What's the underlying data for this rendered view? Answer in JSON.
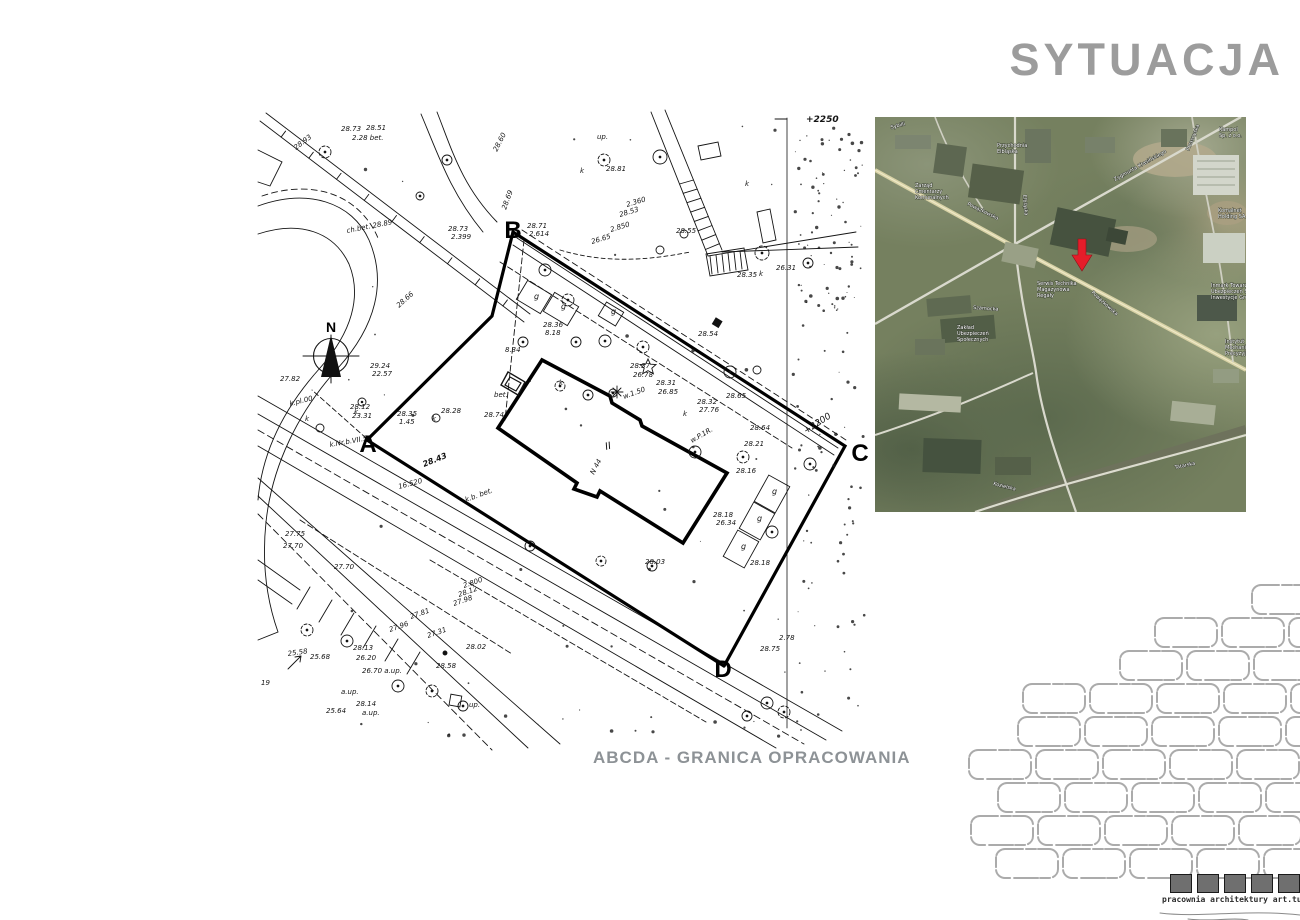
{
  "page": {
    "title": "SYTUACJA",
    "caption": "ABCDA - GRANICA OPRACOWANIA"
  },
  "colors": {
    "title_gray": "#9c9c9c",
    "caption_gray": "#8d9296",
    "map_ink": "#141414",
    "marker_red": "#e51d2a",
    "brick_gray": "#ababab",
    "logo_square_gray": "#6f6f6f"
  },
  "footer": {
    "studio": "pracownia architektury art.tu",
    "square_count": 5
  },
  "site_plan": {
    "north_label": "N",
    "building_label": "II",
    "boundary_points": [
      {
        "label": "A",
        "x": 368,
        "y": 452
      },
      {
        "label": "B",
        "x": 513,
        "y": 238
      },
      {
        "label": "C",
        "x": 860,
        "y": 461
      },
      {
        "label": "D",
        "x": 723,
        "y": 677
      }
    ],
    "annotations": [
      [
        "28.73",
        341,
        131,
        0
      ],
      [
        "28.51",
        366,
        130,
        0
      ],
      [
        "2.28 bet.",
        352,
        140,
        0
      ],
      [
        "28.93",
        296,
        150,
        -37
      ],
      [
        "28.60",
        497,
        152,
        -63
      ],
      [
        "28.69",
        506,
        210,
        -70
      ],
      [
        "28.73",
        448,
        231,
        0
      ],
      [
        "2.399",
        451,
        239,
        0
      ],
      [
        "28.71",
        527,
        228,
        0
      ],
      [
        "2.614",
        529,
        236,
        0
      ],
      [
        "up.",
        597,
        139,
        0
      ],
      [
        "28.81",
        606,
        171,
        0
      ],
      [
        "2.360",
        627,
        207,
        -17
      ],
      [
        "28.53",
        620,
        217,
        -17
      ],
      [
        "2.850",
        611,
        232,
        -17
      ],
      [
        "26.65",
        592,
        244,
        -17
      ],
      [
        "28.55",
        676,
        233,
        0
      ],
      [
        "28.35",
        737,
        277,
        0
      ],
      [
        "26.31",
        776,
        270,
        0
      ],
      [
        "28.54",
        698,
        336,
        0
      ],
      [
        "28.36",
        543,
        327,
        0
      ],
      [
        "8.18",
        545,
        335,
        0
      ],
      [
        "8.34",
        505,
        352,
        0
      ],
      [
        "bet.",
        494,
        397,
        0
      ],
      [
        "28.74",
        484,
        417,
        0
      ],
      [
        "28.37",
        630,
        368,
        0
      ],
      [
        "26.78",
        633,
        377,
        0
      ],
      [
        "28.31",
        656,
        385,
        0
      ],
      [
        "26.85",
        658,
        394,
        0
      ],
      [
        "w.1.50",
        624,
        399,
        -20
      ],
      [
        "28.32",
        697,
        404,
        0
      ],
      [
        "27.76",
        699,
        412,
        0
      ],
      [
        "28.65",
        726,
        398,
        0
      ],
      [
        "28.64",
        750,
        430,
        0
      ],
      [
        "28.21",
        744,
        446,
        0
      ],
      [
        "28.16",
        736,
        473,
        0
      ],
      [
        "w.P.1R.",
        692,
        443,
        -30
      ],
      [
        "N 44",
        594,
        475,
        -62
      ],
      [
        "28.18",
        713,
        517,
        0
      ],
      [
        "26.34",
        716,
        525,
        0
      ],
      [
        "28.18",
        750,
        565,
        0
      ],
      [
        "28.03",
        645,
        564,
        0
      ],
      [
        "28.12",
        350,
        409,
        0
      ],
      [
        "23.31",
        352,
        418,
        0
      ],
      [
        "28.35",
        397,
        416,
        0
      ],
      [
        "1.45",
        399,
        424,
        0
      ],
      [
        "28.28",
        441,
        413,
        0
      ],
      [
        "28.43",
        424,
        467,
        -22,
        8,
        1
      ],
      [
        "16.520",
        399,
        489,
        -15
      ],
      [
        "k.Nr.b.VII.5",
        330,
        447,
        -10
      ],
      [
        "29.24",
        370,
        368,
        0
      ],
      [
        "22.57",
        372,
        376,
        0
      ],
      [
        "ch.bet. 28.89",
        347,
        233,
        -11
      ],
      [
        "28.66",
        399,
        308,
        -42
      ],
      [
        "27.82",
        280,
        381,
        0
      ],
      [
        "k.pl.00",
        290,
        406,
        -14
      ],
      [
        "27.75",
        285,
        536,
        0
      ],
      [
        "27.70",
        283,
        548,
        0
      ],
      [
        "27.70",
        334,
        569,
        0
      ],
      [
        "2.800",
        464,
        588,
        -19
      ],
      [
        "28.12",
        459,
        597,
        -19
      ],
      [
        "27.98",
        454,
        606,
        -19
      ],
      [
        "27.81",
        411,
        619,
        -19
      ],
      [
        "27.96",
        390,
        632,
        -19
      ],
      [
        "27.31",
        428,
        638,
        -19
      ],
      [
        "28.02",
        466,
        649,
        0
      ],
      [
        "28.58",
        436,
        668,
        0
      ],
      [
        "28.13",
        353,
        650,
        0
      ],
      [
        "26.20",
        356,
        660,
        0
      ],
      [
        "26.70 a.up.",
        362,
        673,
        0
      ],
      [
        "25.58",
        288,
        656,
        -8
      ],
      [
        "25.68",
        310,
        659,
        0
      ],
      [
        "25.64",
        326,
        713,
        0
      ],
      [
        "28.14",
        356,
        706,
        0
      ],
      [
        "a.up.",
        362,
        715,
        0
      ],
      [
        "a.up.",
        341,
        694,
        0
      ],
      [
        "up.",
        469,
        707,
        0
      ],
      [
        "19",
        261,
        685,
        0
      ],
      [
        "28.75",
        760,
        651,
        0
      ],
      [
        "2.78",
        779,
        640,
        0
      ],
      [
        "+2250",
        806,
        122,
        0,
        9,
        1
      ],
      [
        "+2200",
        806,
        434,
        -33,
        9,
        0
      ],
      [
        "k.b. bet.",
        466,
        502,
        -20
      ],
      [
        "g",
        534,
        299,
        0,
        8
      ],
      [
        "g",
        561,
        309,
        0,
        8
      ],
      [
        "g",
        611,
        314,
        0,
        8
      ],
      [
        "g",
        772,
        494,
        0,
        8
      ],
      [
        "g",
        757,
        521,
        0,
        8
      ],
      [
        "g",
        741,
        549,
        0,
        8
      ],
      [
        "k",
        354,
        414,
        0
      ],
      [
        "k",
        305,
        421,
        0
      ],
      [
        "k",
        432,
        421,
        0
      ],
      [
        "k",
        683,
        416,
        0
      ],
      [
        "k",
        580,
        173,
        0
      ],
      [
        "k",
        745,
        186,
        0
      ],
      [
        "k",
        759,
        276,
        0
      ],
      [
        "k",
        559,
        385,
        0
      ]
    ]
  },
  "satellite": {
    "labels": [
      [
        "Sybilli",
        16,
        12,
        -15
      ],
      [
        "Kampol",
        344,
        14,
        0
      ],
      [
        "Sp. z o.o.",
        344,
        20,
        0
      ],
      [
        "Przychodnia",
        122,
        30,
        0
      ],
      [
        "Elbląska",
        122,
        36,
        0
      ],
      [
        "Przasnyska",
        314,
        34,
        -68
      ],
      [
        "Zygmunta Krasińskiego",
        240,
        64,
        -29
      ],
      [
        "Elbląska",
        148,
        78,
        85
      ],
      [
        "Powązkowska",
        92,
        88,
        26
      ],
      [
        "Zarząd",
        40,
        70,
        0
      ],
      [
        "Cmentarzy",
        40,
        76,
        0
      ],
      [
        "Komunalnych",
        40,
        82,
        0
      ],
      [
        "Komalnet",
        343,
        95,
        0
      ],
      [
        "Holding SA",
        343,
        101,
        0
      ],
      [
        "Powązkowska",
        216,
        176,
        42
      ],
      [
        "Serwis Technika",
        162,
        168,
        0
      ],
      [
        "Magazynowa",
        162,
        174,
        0
      ],
      [
        "Regały",
        162,
        180,
        0
      ],
      [
        "Inmark Towarzystwo",
        336,
        170,
        0
      ],
      [
        "Ubezpieczeń SA Verma",
        336,
        176,
        0
      ],
      [
        "Inwestycje Grupy",
        336,
        182,
        0
      ],
      [
        "Szamocka",
        98,
        192,
        4
      ],
      [
        "Zakład",
        82,
        212,
        0
      ],
      [
        "Ubezpieczeń",
        82,
        218,
        0
      ],
      [
        "Społecznych",
        82,
        224,
        0
      ],
      [
        "Instytut",
        350,
        226,
        0
      ],
      [
        "Mechaniki",
        350,
        232,
        0
      ],
      [
        "Precyzyjnej",
        350,
        238,
        0
      ],
      [
        "Kozielska",
        118,
        368,
        14
      ],
      [
        "Tatarska",
        300,
        352,
        -12
      ]
    ]
  }
}
